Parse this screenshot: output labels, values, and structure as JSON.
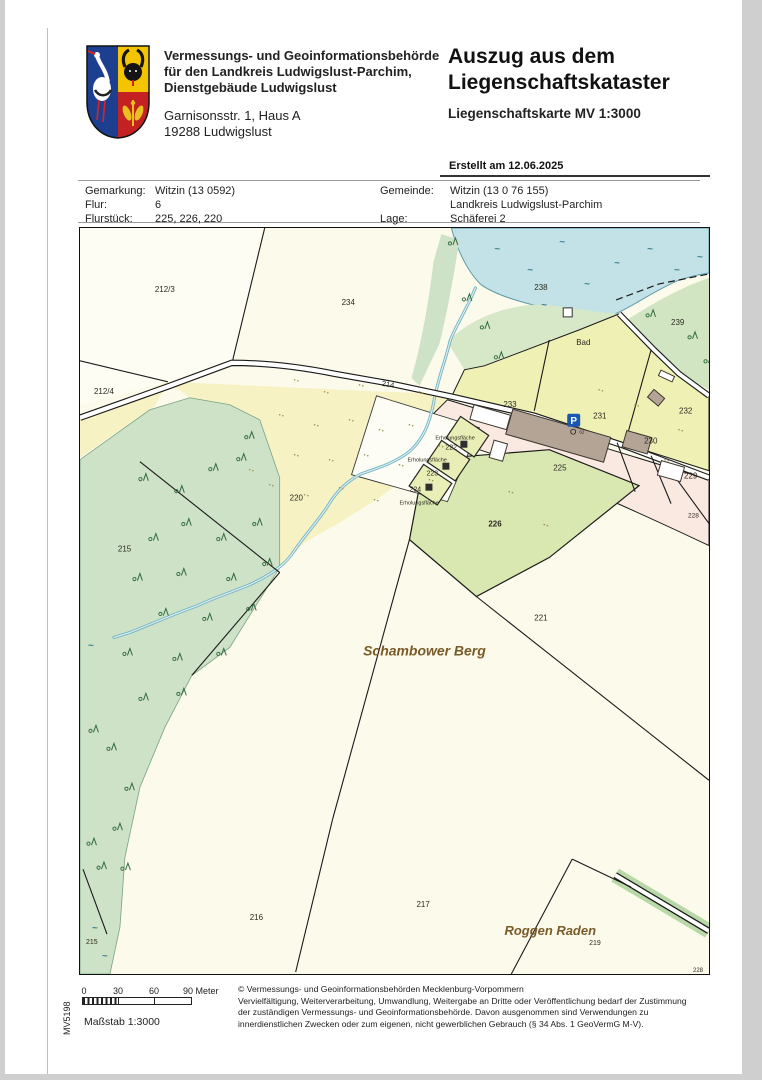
{
  "header": {
    "authority_lines": [
      "Vermessungs- und Geoinformationsbehörde",
      "für den Landkreis Ludwigslust-Parchim,",
      "Dienstgebäude Ludwigslust"
    ],
    "address_lines": [
      "Garnisonsstr. 1, Haus A",
      "19288 Ludwigslust"
    ],
    "title_lines": [
      "Auszug aus dem",
      "Liegenschaftskataster"
    ],
    "subtitle": "Liegenschaftskarte MV 1:3000",
    "created": "Erstellt am 12.06.2025"
  },
  "info": {
    "rows": [
      {
        "l1": "Gemarkung:",
        "v1": "Witzin (13 0592)",
        "l2": "Gemeinde:",
        "v2": "Witzin (13 0 76 155)"
      },
      {
        "l1": "Flur:",
        "v1": "6",
        "l2": "",
        "v2": "Landkreis Ludwigslust-Parchim"
      },
      {
        "l1": "Flurstück:",
        "v1": "225, 226, 220",
        "l2": "Lage:",
        "v2": "Schäferei 2"
      }
    ]
  },
  "map": {
    "parking": {
      "label": "P"
    },
    "labels": [
      {
        "t": "212/3",
        "x": 75,
        "y": 64
      },
      {
        "t": "234",
        "x": 262,
        "y": 77
      },
      {
        "t": "238",
        "x": 455,
        "y": 62
      },
      {
        "t": "239",
        "x": 592,
        "y": 97
      },
      {
        "t": "Bad",
        "x": 497,
        "y": 117
      },
      {
        "t": "212/4",
        "x": 14,
        "y": 166
      },
      {
        "t": "214",
        "x": 302,
        "y": 158,
        "s": 7.5,
        "r": 9
      },
      {
        "t": "233",
        "x": 424,
        "y": 179
      },
      {
        "t": "231",
        "x": 514,
        "y": 191
      },
      {
        "t": "232",
        "x": 600,
        "y": 186
      },
      {
        "t": "230",
        "x": 565,
        "y": 216
      },
      {
        "t": "229",
        "x": 605,
        "y": 251
      },
      {
        "t": "225",
        "x": 474,
        "y": 243
      },
      {
        "t": "Erholungsfläche",
        "x": 356,
        "y": 212,
        "s": 5.5
      },
      {
        "t": "222",
        "x": 366,
        "y": 222,
        "s": 7
      },
      {
        "t": "Erholungsfläche",
        "x": 328,
        "y": 234,
        "s": 5.5
      },
      {
        "t": "223",
        "x": 347,
        "y": 248,
        "s": 7
      },
      {
        "t": "224",
        "x": 330,
        "y": 264,
        "s": 7
      },
      {
        "t": "Erholungsfläche",
        "x": 320,
        "y": 277,
        "s": 5.5
      },
      {
        "t": "220",
        "x": 210,
        "y": 273
      },
      {
        "t": "215",
        "x": 38,
        "y": 324
      },
      {
        "t": "226",
        "x": 409,
        "y": 299,
        "b": 1
      },
      {
        "t": "221",
        "x": 455,
        "y": 393
      },
      {
        "t": "Schambower Berg",
        "x": 345,
        "y": 428,
        "s": 14,
        "c": "#7a5b28",
        "b": 1,
        "i": 1,
        "a": "middle"
      },
      {
        "t": "216",
        "x": 170,
        "y": 693
      },
      {
        "t": "217",
        "x": 337,
        "y": 680
      },
      {
        "t": "Roggen Raden",
        "x": 471,
        "y": 708,
        "s": 13,
        "c": "#7a5b28",
        "b": 1,
        "i": 1,
        "a": "middle"
      },
      {
        "t": "219",
        "x": 510,
        "y": 718,
        "s": 7
      },
      {
        "t": "215",
        "x": 6,
        "y": 717,
        "s": 7
      },
      {
        "t": "228",
        "x": 609,
        "y": 290,
        "s": 6.5
      },
      {
        "t": "228",
        "x": 614,
        "y": 745,
        "s": 6
      },
      {
        "t": "62",
        "x": 500,
        "y": 206,
        "s": 4.5
      }
    ],
    "trees": [
      [
        62,
        252
      ],
      [
        98,
        264
      ],
      [
        132,
        242
      ],
      [
        160,
        232
      ],
      [
        105,
        297
      ],
      [
        72,
        312
      ],
      [
        140,
        312
      ],
      [
        176,
        297
      ],
      [
        56,
        352
      ],
      [
        100,
        347
      ],
      [
        150,
        352
      ],
      [
        186,
        337
      ],
      [
        82,
        387
      ],
      [
        126,
        392
      ],
      [
        170,
        382
      ],
      [
        46,
        427
      ],
      [
        96,
        432
      ],
      [
        140,
        427
      ],
      [
        62,
        472
      ],
      [
        100,
        467
      ],
      [
        30,
        522
      ],
      [
        48,
        562
      ],
      [
        36,
        602
      ],
      [
        44,
        642
      ],
      [
        12,
        504
      ],
      [
        10,
        617
      ],
      [
        20,
        641
      ],
      [
        168,
        210
      ],
      [
        372,
        16
      ],
      [
        386,
        72
      ],
      [
        404,
        100
      ],
      [
        418,
        130
      ],
      [
        570,
        88
      ],
      [
        612,
        110
      ],
      [
        628,
        134
      ]
    ],
    "waves": [
      [
        415,
        24
      ],
      [
        448,
        45
      ],
      [
        480,
        17
      ],
      [
        505,
        59
      ],
      [
        535,
        38
      ],
      [
        568,
        24
      ],
      [
        595,
        45
      ],
      [
        618,
        32
      ],
      [
        462,
        80
      ],
      [
        12,
        704
      ],
      [
        22,
        732
      ],
      [
        8,
        421
      ]
    ],
    "dots": [
      [
        215,
        152
      ],
      [
        245,
        164
      ],
      [
        280,
        157
      ],
      [
        310,
        172
      ],
      [
        340,
        164
      ],
      [
        200,
        187
      ],
      [
        235,
        197
      ],
      [
        270,
        192
      ],
      [
        300,
        202
      ],
      [
        330,
        197
      ],
      [
        215,
        227
      ],
      [
        250,
        232
      ],
      [
        285,
        227
      ],
      [
        320,
        237
      ],
      [
        190,
        257
      ],
      [
        225,
        267
      ],
      [
        260,
        260
      ],
      [
        295,
        272
      ],
      [
        170,
        242
      ],
      [
        350,
        252
      ],
      [
        360,
        218
      ],
      [
        430,
        264
      ],
      [
        465,
        297
      ],
      [
        520,
        162
      ],
      [
        556,
        177
      ],
      [
        600,
        202
      ],
      [
        586,
        232
      ]
    ]
  },
  "footer": {
    "scale_ticks": [
      "0",
      "30",
      "60"
    ],
    "scale_end": "90 Meter",
    "masstab": "Maßstab 1:3000",
    "sheet": "MV5198",
    "copyright": [
      "© Vermessungs- und Geoinformationsbehörden Mecklenburg-Vorpommern",
      "Vervielfältigung, Weiterverarbeitung, Umwandlung, Weitergabe an Dritte oder Veröffentlichung bedarf der Zustimmung",
      "der zuständigen Vermessungs- und Geoinformationsbehörde. Davon ausgenommen sind Verwendungen zu",
      "innerdienstlichen Zwecken oder zum eigenen, nicht gewerblichen Gebrauch (§ 34 Abs. 1 GeoVermG M-V)."
    ]
  },
  "colors": {
    "water": "#c3e2e8",
    "forest": "#cde2c6",
    "field_yellow": "#f6f2c4",
    "settlement_green": "#eef0b4",
    "parcel_green": "#d8e8b0",
    "built_pink": "#f9e9e1",
    "building_gray": "#b3a496",
    "label_brown": "#7a5b28",
    "parking_blue": "#1a57b0"
  }
}
